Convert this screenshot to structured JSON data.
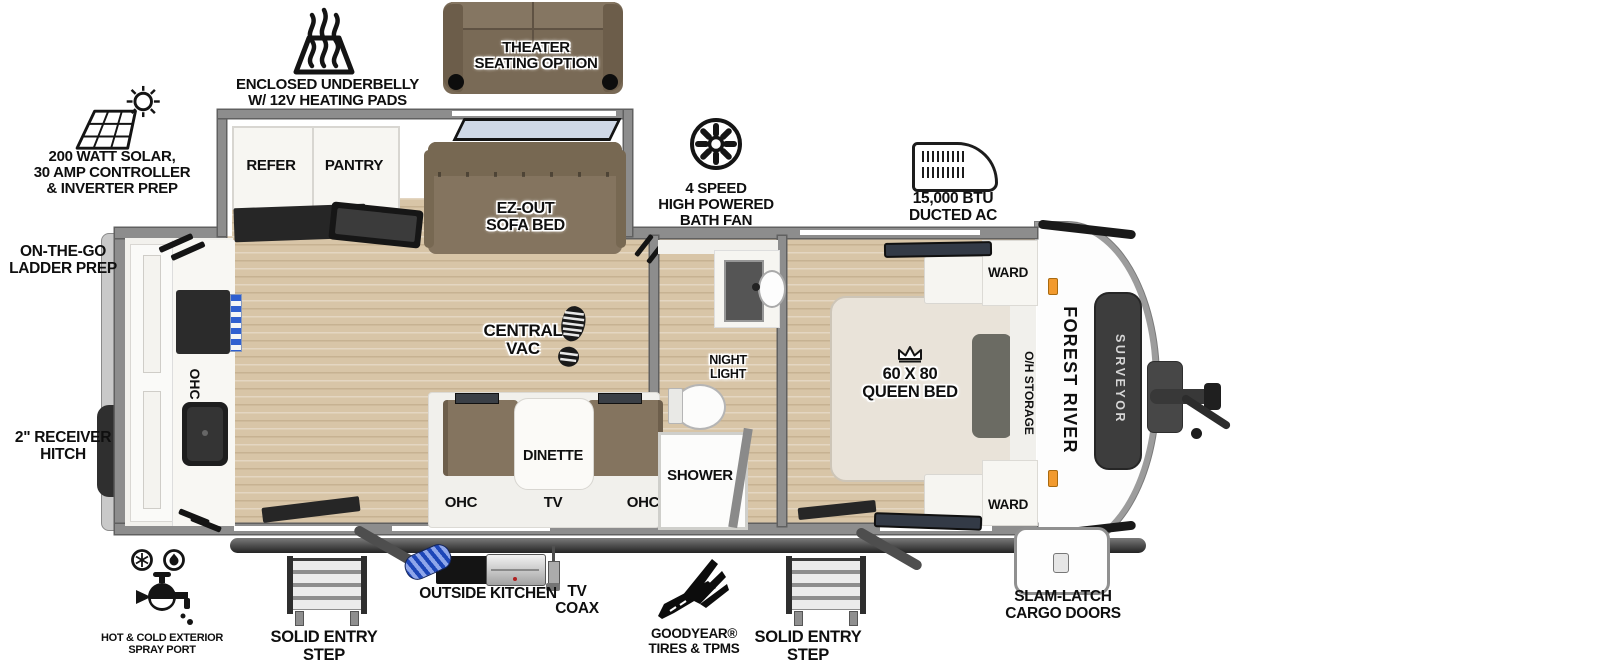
{
  "colors": {
    "floor_tan": "#d8c5a7",
    "wall_gray": "#8d8d8d",
    "sofa_brown": "#84745f",
    "cabinet_white": "#f4f3ef",
    "counter_dark": "#262626",
    "brand_panel_dark": "#3d3d3d",
    "marker_light_orange": "#f29a2e",
    "frame_dark": "#3a3a3a",
    "window_blue": "#cfd8e6",
    "hose_blue": "#1d46b8"
  },
  "branding": {
    "manufacturer": "FOREST RIVER",
    "model": "SURVEYOR"
  },
  "callouts": {
    "solar": "200 WATT SOLAR,\n30 AMP CONTROLLER\n& INVERTER PREP",
    "underbelly": "ENCLOSED UNDERBELLY\nW/ 12V HEATING PADS",
    "theater": "THEATER\nSEATING OPTION",
    "bath_fan": "4 SPEED\nHIGH POWERED\nBATH FAN",
    "ducted_ac": "15,000 BTU\nDUCTED AC",
    "ladder_prep": "ON-THE-GO\nLADDER PREP",
    "receiver_hitch": "2\" RECEIVER\nHITCH",
    "spray_port": "HOT & COLD EXTERIOR\nSPRAY PORT",
    "entry_step_main": "SOLID ENTRY\nSTEP",
    "outside_kitchen": "OUTSIDE KITCHEN",
    "tv_coax": "TV\nCOAX",
    "tires": "GOODYEAR®\nTIRES & TPMS",
    "entry_step_bedroom": "SOLID ENTRY\nSTEP",
    "cargo_doors": "SLAM-LATCH\nCARGO DOORS"
  },
  "rooms": {
    "refer": "REFER",
    "pantry": "PANTRY",
    "sofa_bed": "EZ-OUT\nSOFA BED",
    "central_vac": "CENTRAL\nVAC",
    "dinette": "DINETTE",
    "ohc_left": "OHC",
    "tv": "TV",
    "ohc_right": "OHC",
    "ohc_rear": "OHC",
    "night_light": "NIGHT\nLIGHT",
    "shower": "SHOWER",
    "queen_bed": "60 X 80\nQUEEN BED",
    "ward_top": "WARD",
    "ward_bottom": "WARD",
    "oh_storage": "O/H STORAGE"
  }
}
